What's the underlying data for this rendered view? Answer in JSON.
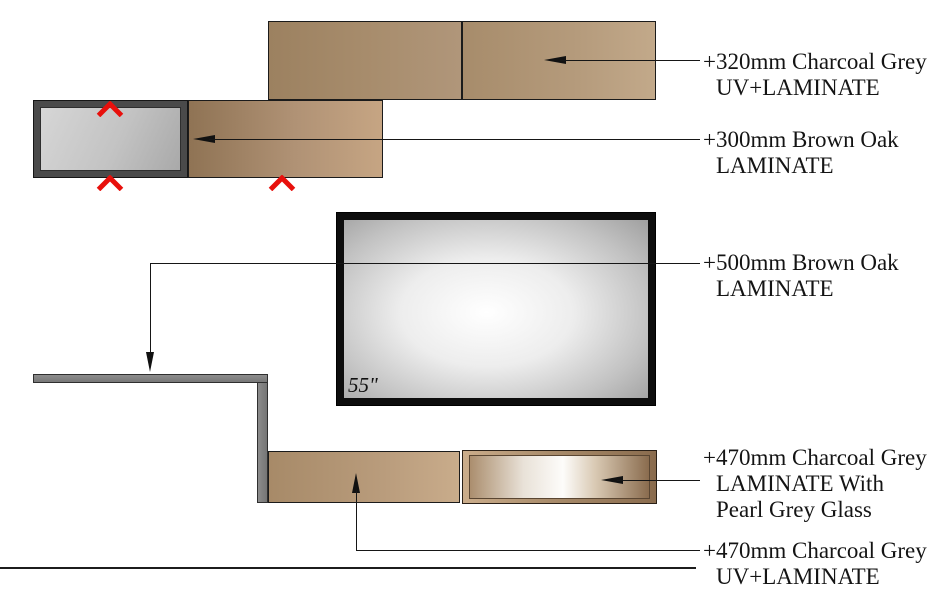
{
  "annotations": [
    {
      "id": "top-320",
      "lines": [
        "+320mm Charcoal Grey",
        "UV+LAMINATE"
      ]
    },
    {
      "id": "shelf-300",
      "lines": [
        "+300mm Brown Oak",
        "LAMINATE"
      ]
    },
    {
      "id": "back-500",
      "lines": [
        "+500mm Brown Oak",
        "LAMINATE"
      ]
    },
    {
      "id": "base-470-glass",
      "lines": [
        "+470mm Charcoal Grey",
        "LAMINATE With",
        "Pearl Grey Glass"
      ]
    },
    {
      "id": "base-470-uv",
      "lines": [
        "+470mm Charcoal Grey",
        "UV+LAMINATE"
      ]
    }
  ],
  "tv": {
    "size_label": "55\""
  },
  "icons": {
    "marker": "chevron-up",
    "leader_end": "solid-arrowhead"
  },
  "colors": {
    "wood_brown_dark": "#9c8160",
    "wood_brown_light": "#c6a583",
    "charcoal_grey_frame": "#4a4a4a",
    "panel_light_grey": "#c6c6c6",
    "shelf_grey": "#7e7e7e",
    "marker_red": "#e8100c",
    "tv_frame_black": "#0d0d0d",
    "glass_white": "#fdfcfa",
    "line_color": "#161616"
  }
}
